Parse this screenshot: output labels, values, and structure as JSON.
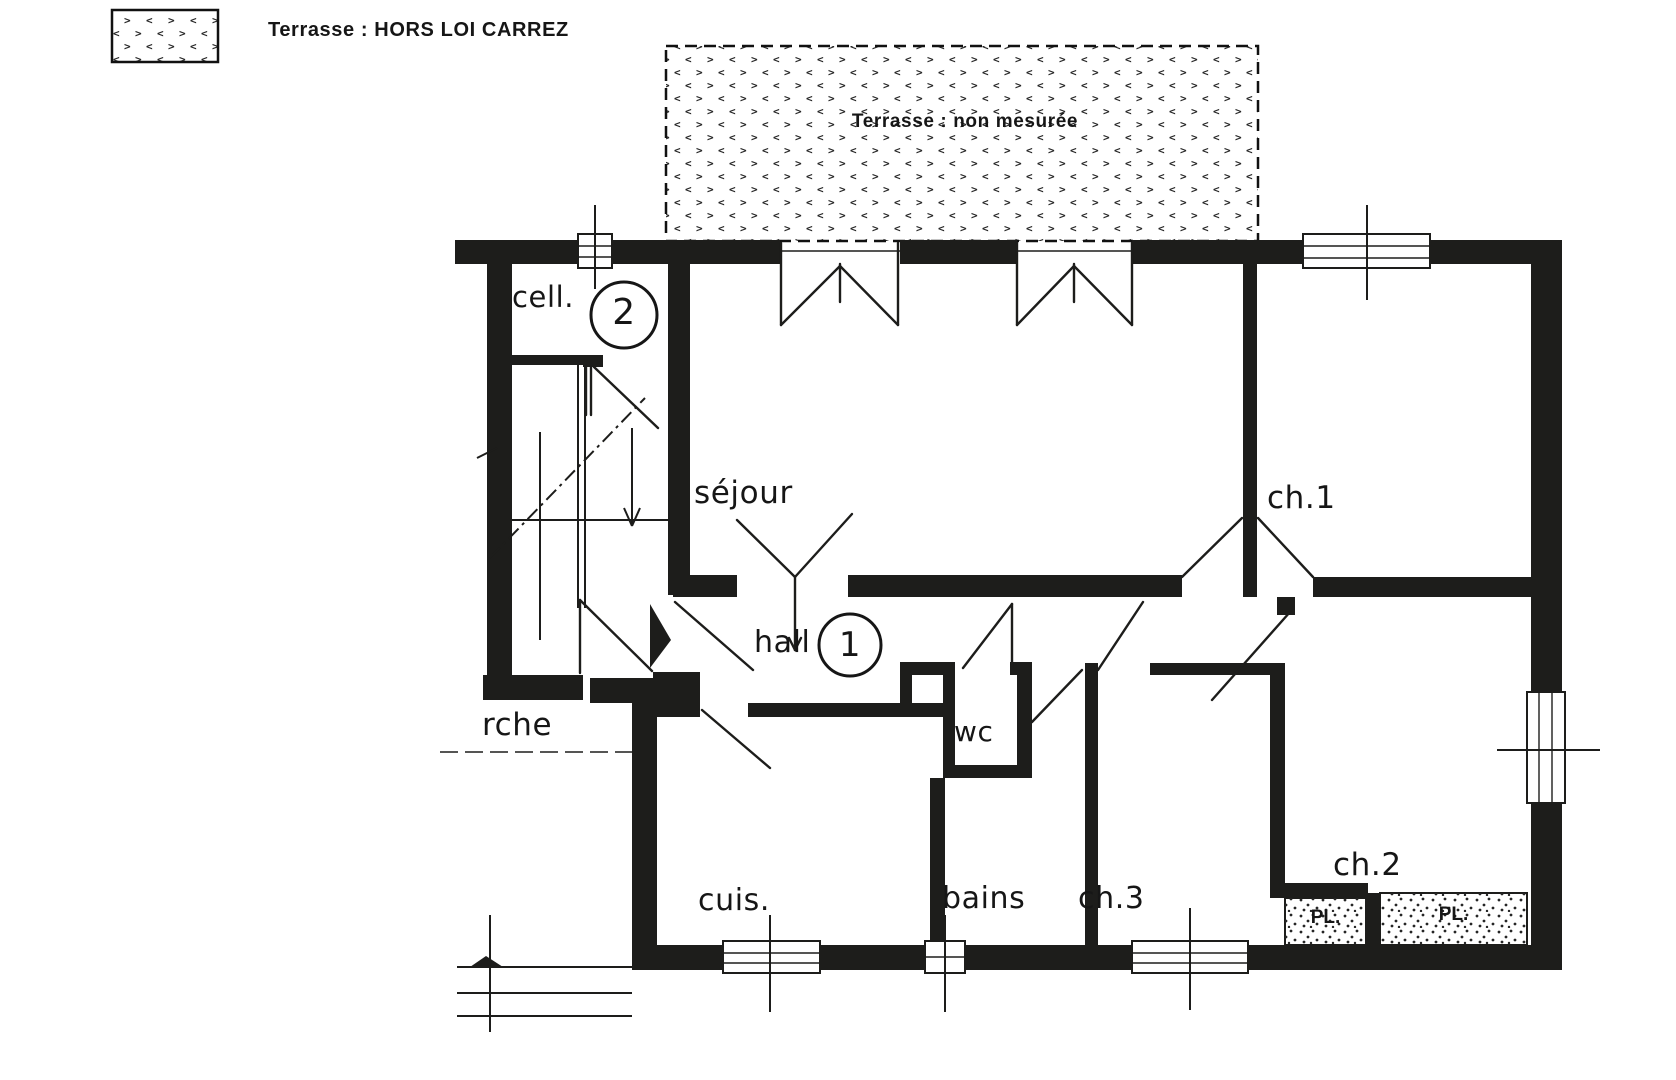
{
  "legend": {
    "terrace_note": "Terrasse : HORS LOI CARREZ"
  },
  "terrace": {
    "label": "Terrasse : non mesurée"
  },
  "rooms": {
    "cellier": {
      "label": "cell.",
      "lot_number": "2"
    },
    "sejour": {
      "label": "séjour"
    },
    "ch1": {
      "label": "ch.1"
    },
    "hall": {
      "label": "hall",
      "lot_number": "1"
    },
    "wc": {
      "label": "wc"
    },
    "cuisine": {
      "label": "cuis."
    },
    "bains": {
      "label": "bains"
    },
    "ch3": {
      "label": "ch.3"
    },
    "ch2": {
      "label": "ch.2"
    },
    "placard_1": {
      "label": "PL."
    },
    "placard_2": {
      "label": "PL."
    },
    "porche": {
      "label": "rche"
    }
  },
  "colors": {
    "wall": "#1d1d1b",
    "paper": "#ffffff",
    "pattern": "#262626"
  }
}
